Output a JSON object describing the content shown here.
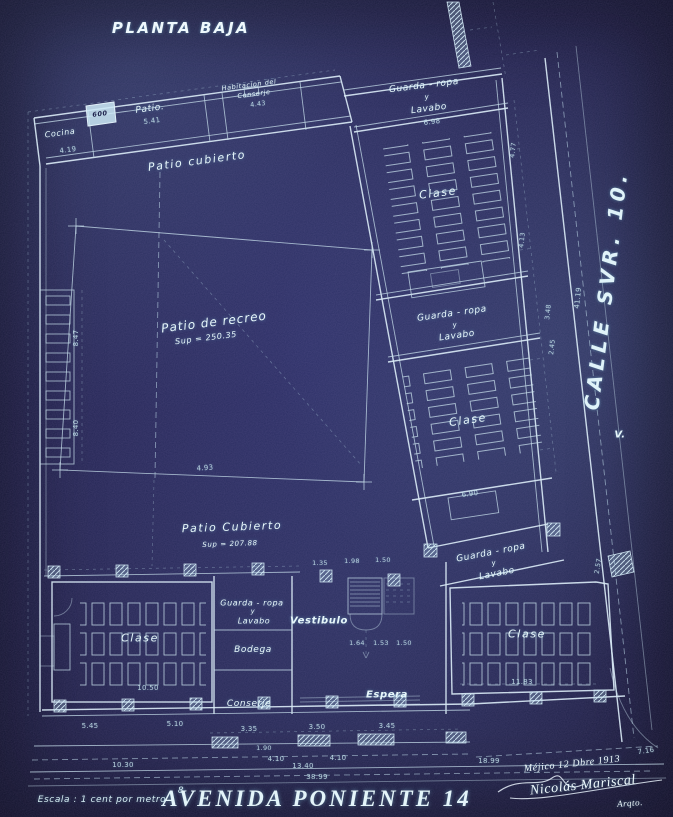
{
  "header": {
    "title": "PLANTA BAJA"
  },
  "streets": {
    "avenida": "AVENIDA PONIENTE 14",
    "calle": "CALLE SVR. 10.",
    "escala": "Escala : 1 cent por metro"
  },
  "rooms": {
    "cocina": "Cocina",
    "patio_top": "Patio.",
    "habitacion_1": "Habitacion del",
    "habitacion_2": "Conserje",
    "patio_cubierto_top": "Patio cubierto",
    "patio_recreo": "Patio de recreo",
    "patio_recreo_sup": "Sup = 250.35",
    "patio_cubierto_bottom": "Patio Cubierto",
    "patio_cubierto_sup": "Sup = 207.88",
    "guardarropa": "Guarda - ropa",
    "guardarropa_y": "y",
    "lavabo": "Lavabo",
    "clase": "Clase",
    "vestibulo": "Vestibulo",
    "bodega": "Bodega",
    "conserje": "Conserje",
    "espera": "Espera"
  },
  "marks": {
    "v": "V.",
    "wc": "600",
    "sec": "8"
  },
  "dims": {
    "a690": "6.90",
    "a1050": "10.50",
    "a1183": "11.83",
    "a1030": "10.30",
    "a1340": "13.40",
    "a3899": "38.99",
    "a1899": "18.99",
    "a716": "7.16",
    "a541": "5.41",
    "a443": "4.43",
    "a419": "4.19",
    "a493": "4.93",
    "a847": "8.47",
    "a840": "8.40",
    "a698": "6.98",
    "a4119": "41.19",
    "a190": "1.90",
    "a335": "3.35",
    "a350": "3.50",
    "a345": "3.45",
    "a410": "4.10",
    "a545": "5.45",
    "a510": "5.10",
    "a164": "1.64",
    "a153": "1.53",
    "a150": "1.50",
    "a135": "1.35",
    "a198": "1.98",
    "a477": "4.77",
    "a413": "4.13",
    "a348": "3.48",
    "a245": "2.45",
    "a257": "2.57"
  },
  "signature": {
    "line1": "Méjico 12 Dbre 1913",
    "line2": "Nicolás Mariscal",
    "line3": "Arqto."
  }
}
